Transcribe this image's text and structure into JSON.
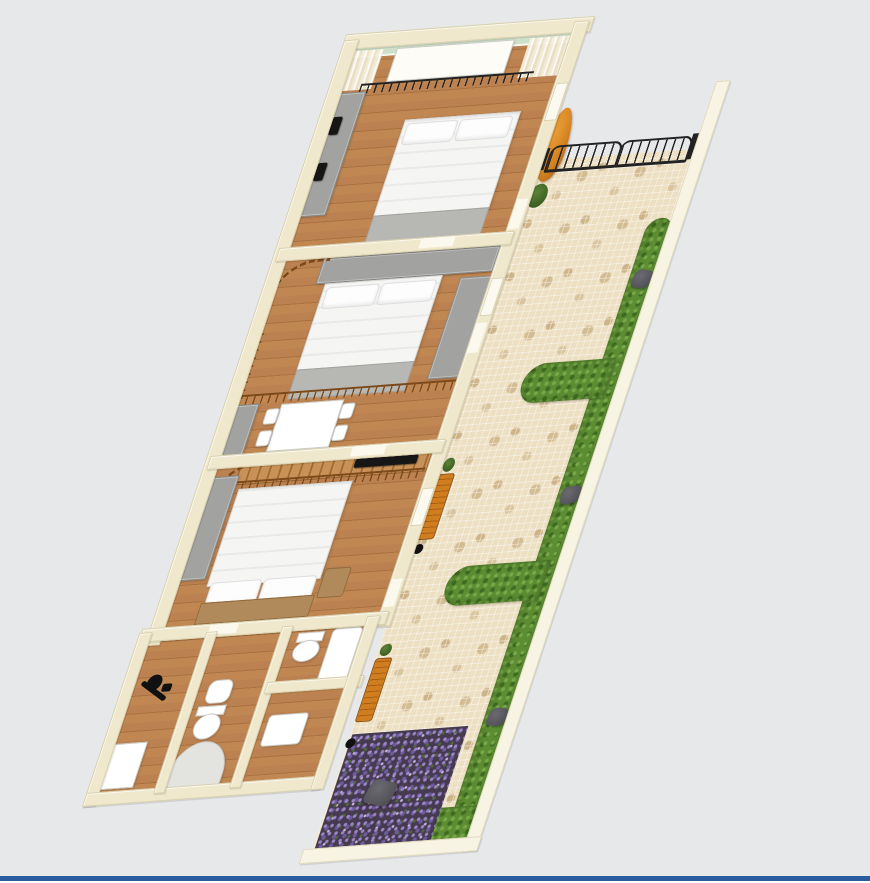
{
  "scene": {
    "type": "3d-floorplan-render",
    "view": "tilted top-down perspective, plan rotated about 20 degrees",
    "rooms": [
      {
        "id": "bedroom-top",
        "furniture": [
          "double-bed",
          "wardrobe",
          "balcony-planter",
          "railing",
          "curtains",
          "glass-wall"
        ]
      },
      {
        "id": "bedroom-middle",
        "furniture": [
          "double-bed",
          "wardrobes",
          "spiral-stair-railing",
          "mezzanine-railing"
        ]
      },
      {
        "id": "dining-area",
        "furniture": [
          "white-table",
          "four-chairs",
          "cabinet"
        ]
      },
      {
        "id": "master-bedroom",
        "furniture": [
          "double-bed",
          "wardrobe",
          "wall-tv",
          "staircase-with-railing",
          "bedside-table"
        ]
      },
      {
        "id": "ensuite-wc",
        "furniture": [
          "toilet",
          "bathtub"
        ]
      },
      {
        "id": "utility-room",
        "furniture": [
          "exercise-equipment",
          "white-counter"
        ]
      },
      {
        "id": "bathroom",
        "furniture": [
          "bidet",
          "toilet",
          "corner-shower"
        ]
      },
      {
        "id": "laundry-room",
        "furniture": [
          "white-appliance"
        ]
      },
      {
        "id": "courtyard",
        "features": [
          "stone-mosaic-paving",
          "wrought-iron-gate",
          "perimeter-hedge",
          "two-hedge-branches",
          "three-hedge-lights",
          "lavender-bed",
          "two-orange-benches",
          "orange-tree",
          "green-bushes"
        ]
      }
    ],
    "counts": {
      "beds": 3,
      "toilets": 2,
      "bidet": 1,
      "corner_shower": 1,
      "benches": 2,
      "hedge_lights": 3,
      "hedge_branches": 2
    }
  },
  "colors": {
    "bg": "#e7e8e9",
    "window_border": "#2a5c9e",
    "wall": "#efe8cc",
    "wall_edge": "#d8d0ae",
    "wall_white": "#f8f4e4",
    "wood": "#bd8352",
    "stone": "#ecdfc2",
    "stone_patch": "#cdb488",
    "hedge": "#5d8d33",
    "hedge_dark": "#3f6b22",
    "hedge_light": "#7aa94b",
    "lavender_bg": "#463a50",
    "lavender": "#9b87c6",
    "iron": "#222222",
    "rail_brown": "#7c4a1a",
    "furn_gray": "#a2a3a0",
    "bed_white": "#f5f5f4",
    "bed_foot": "#b7b8b4",
    "head_tan": "#b08a5a",
    "bench_orange": "#cf7d1e",
    "tree_orange": "#d3801f",
    "glass": "#cfe0ca",
    "fixture_white": "#ffffff",
    "rock_gray": "#55555a",
    "tv_black": "#161616"
  }
}
